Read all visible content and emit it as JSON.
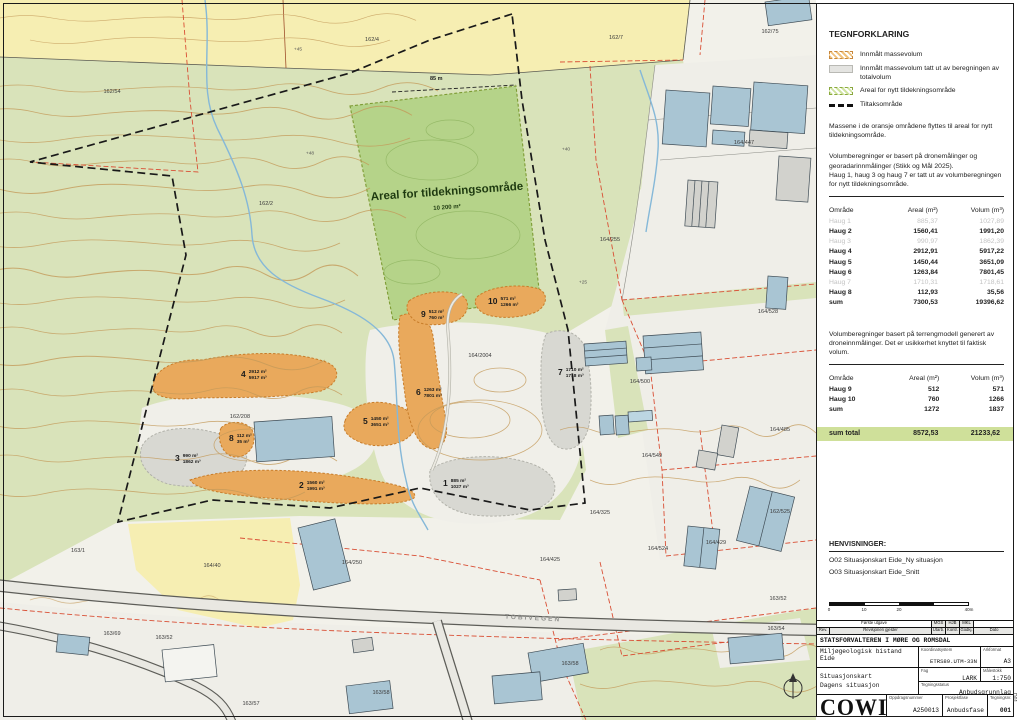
{
  "panel": {
    "legend_title": "TEGNFORKLARING",
    "legend_items": [
      {
        "swatch": "orange-hatch",
        "label": "Innmålt massevolum"
      },
      {
        "swatch": "gray",
        "label": "Innmålt massevolum tatt ut av beregningen av totalvolum"
      },
      {
        "swatch": "green-hatch",
        "label": "Areal for nytt tildekningsområde"
      },
      {
        "swatch": "black-dash",
        "label": "Tiltaksområde"
      }
    ],
    "note_orange": "Massene i de oransje områdene flyttes til areal for nytt tildekningsområde.",
    "note_volume": "Volumberegninger er basert på dronemålinger og georadarinnmålinger (Stikk og Mål 2025).\nHaug 1, haug 3 og haug 7 er tatt ut av volumberegningen for nytt tildekningsområde.",
    "note_terrain": "Volumberegninger basert på terrengmodell generert av droneinnmålinger. Det er usikkerhet knyttet til faktisk volum.",
    "henvisninger_title": "HENVISNINGER:",
    "henvisninger_items": [
      "O02 Situasjonskart Eide_Ny situasjon",
      "O03 Situasjonskart Eide_Snitt"
    ],
    "scalebar_ticks": [
      "0",
      "10",
      "20",
      "40m"
    ]
  },
  "table1": {
    "headers": [
      "Område",
      "Areal (m²)",
      "Volum (m³)"
    ],
    "rows": [
      {
        "name": "Haug 1",
        "areal": "885,37",
        "volum": "1027,89",
        "muted": true
      },
      {
        "name": "Haug 2",
        "areal": "1560,41",
        "volum": "1991,20"
      },
      {
        "name": "Haug 3",
        "areal": "990,97",
        "volum": "1862,39",
        "muted": true
      },
      {
        "name": "Haug 4",
        "areal": "2912,91",
        "volum": "5917,22"
      },
      {
        "name": "Haug 5",
        "areal": "1450,44",
        "volum": "3651,09"
      },
      {
        "name": "Haug 6",
        "areal": "1263,84",
        "volum": "7801,45"
      },
      {
        "name": "Haug 7",
        "areal": "1710,31",
        "volum": "1718,61",
        "muted": true
      },
      {
        "name": "Haug 8",
        "areal": "112,93",
        "volum": "35,56"
      },
      {
        "name": "sum",
        "areal": "7300,53",
        "volum": "19396,62"
      }
    ]
  },
  "table2": {
    "headers": [
      "Område",
      "Areal (m²)",
      "Volum (m³)"
    ],
    "rows": [
      {
        "name": "Haug 9",
        "areal": "512",
        "volum": "571"
      },
      {
        "name": "Haug 10",
        "areal": "760",
        "volum": "1266"
      },
      {
        "name": "sum",
        "areal": "1272",
        "volum": "1837"
      }
    ]
  },
  "sum_total": {
    "label": "sum total",
    "areal": "8572,53",
    "volum": "21233,62"
  },
  "titleblock": {
    "rev_entry_desc": "Første utgave",
    "rev_initials": [
      "MGS",
      "HJB",
      "MKL"
    ],
    "rev_header": {
      "rev": "Rev.",
      "desc": "Revisjonen gjelder",
      "utarb": "Utarb.",
      "kontr": "Kontr.",
      "godkj": "Godkj.",
      "dato": "Dato"
    },
    "client": "STATSFORVALTEREN I MØRE OG ROMSDAL",
    "project": "Miljøgeologisk bistand Eide",
    "title_line1": "Situasjonskart",
    "title_line2": "Dagens situasjon",
    "coord_label": "Koordinatsystem",
    "coord_value": "ETRS89.UTM-33N",
    "format_label": "Arkformat",
    "format_value": "A3",
    "fag_label": "Fag",
    "fag_value": "LARK",
    "scale_label": "Målestokk",
    "scale_value": "1:750",
    "status_label": "Tegningsstatus",
    "status_value": "Anbudsgrunnlag",
    "logo": "COWI",
    "order_label": "Oppdragsnummer",
    "order_value": "A250013",
    "phase_label": "Prosjektfase",
    "phase_value": "Anbudsfase",
    "number_label": "Tegningsnr.",
    "number_value": "001",
    "side_code": "D01"
  },
  "map": {
    "area_label": "Areal for tildekningsområde",
    "area_value": "10 200 m²",
    "road_label": "TOBIVEGEN",
    "dist_label": "85 m",
    "haugs": [
      {
        "n": "1",
        "areal": "885 m²",
        "volum": "1027 m³",
        "x": 443,
        "y": 479
      },
      {
        "n": "2",
        "areal": "1560 m²",
        "volum": "1991 m³",
        "x": 299,
        "y": 481
      },
      {
        "n": "3",
        "areal": "990 m²",
        "volum": "1862 m³",
        "x": 175,
        "y": 454
      },
      {
        "n": "4",
        "areal": "2912 m²",
        "volum": "5917 m³",
        "x": 241,
        "y": 370
      },
      {
        "n": "5",
        "areal": "1450 m²",
        "volum": "3651 m³",
        "x": 363,
        "y": 417
      },
      {
        "n": "6",
        "areal": "1263 m²",
        "volum": "7801 m³",
        "x": 416,
        "y": 388
      },
      {
        "n": "7",
        "areal": "1710 m²",
        "volum": "1718 m³",
        "x": 558,
        "y": 368
      },
      {
        "n": "8",
        "areal": "112 m²",
        "volum": "35 m³",
        "x": 229,
        "y": 434
      },
      {
        "n": "9",
        "areal": "512 m²",
        "volum": "760 m³",
        "x": 421,
        "y": 310
      },
      {
        "n": "10",
        "areal": "571 m²",
        "volum": "1266 m³",
        "x": 488,
        "y": 297
      }
    ],
    "parcels": [
      {
        "t": "162/54",
        "x": 112,
        "y": 92
      },
      {
        "t": "162/4",
        "x": 372,
        "y": 40
      },
      {
        "t": "162/2",
        "x": 266,
        "y": 204
      },
      {
        "t": "162/7",
        "x": 616,
        "y": 38
      },
      {
        "t": "162/75",
        "x": 770,
        "y": 32
      },
      {
        "t": "164/447",
        "x": 744,
        "y": 143
      },
      {
        "t": "164/255",
        "x": 610,
        "y": 240
      },
      {
        "t": "164/528",
        "x": 768,
        "y": 312
      },
      {
        "t": "164/500",
        "x": 640,
        "y": 382
      },
      {
        "t": "164/485",
        "x": 780,
        "y": 430
      },
      {
        "t": "164/549",
        "x": 652,
        "y": 456
      },
      {
        "t": "164/325",
        "x": 600,
        "y": 513
      },
      {
        "t": "162/525",
        "x": 780,
        "y": 512
      },
      {
        "t": "164/524",
        "x": 658,
        "y": 549
      },
      {
        "t": "164/429",
        "x": 716,
        "y": 543
      },
      {
        "t": "164/425",
        "x": 550,
        "y": 560
      },
      {
        "t": "163/1",
        "x": 78,
        "y": 551
      },
      {
        "t": "164/40",
        "x": 212,
        "y": 566
      },
      {
        "t": "164/250",
        "x": 352,
        "y": 563
      },
      {
        "t": "163/69",
        "x": 112,
        "y": 634
      },
      {
        "t": "163/52",
        "x": 164,
        "y": 638
      },
      {
        "t": "163/57",
        "x": 251,
        "y": 704
      },
      {
        "t": "163/58",
        "x": 381,
        "y": 693
      },
      {
        "t": "163/52",
        "x": 778,
        "y": 599
      },
      {
        "t": "163/54",
        "x": 776,
        "y": 629
      },
      {
        "t": "163/58",
        "x": 570,
        "y": 664
      },
      {
        "t": "164/2004",
        "x": 480,
        "y": 356
      },
      {
        "t": "162/208",
        "x": 240,
        "y": 417
      }
    ],
    "elevations": [
      {
        "t": "+45",
        "x": 298,
        "y": 50
      },
      {
        "t": "+48",
        "x": 310,
        "y": 154
      },
      {
        "t": "+40",
        "x": 566,
        "y": 150
      },
      {
        "t": "+25",
        "x": 583,
        "y": 283
      }
    ]
  },
  "colors": {
    "orange": "#e9a95c",
    "tildekning_green": "#b5d389",
    "highlight_green": "#cfe09a",
    "muted_gray": "#c3c3c3"
  }
}
